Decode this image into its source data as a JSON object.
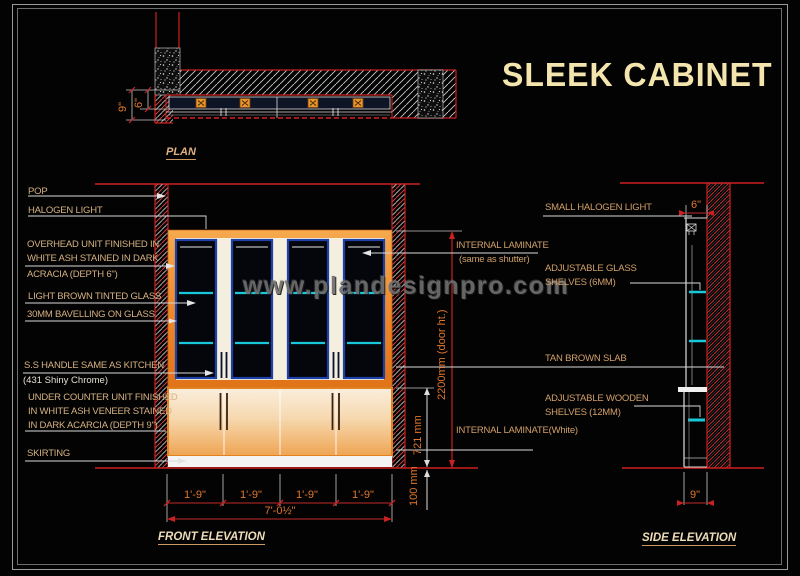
{
  "title": "SLEEK CABINET",
  "watermark": "www.plandesignpro.com",
  "colors": {
    "background": "#030303",
    "wall_red": "#cc2020",
    "cabinet_orange": "#e8872a",
    "shelf_cyan": "#18c8d8",
    "door_navy": "#1d41a8",
    "callout_tan": "#d6b283",
    "dim_orange": "#e0762c",
    "title_cream": "#f3e5ad"
  },
  "plan": {
    "label": "PLAN",
    "dim_depth_total": "9\"",
    "dim_depth_unit": "6\""
  },
  "front": {
    "label": "FRONT ELEVATION",
    "dim_segment": "1'-9\"",
    "dim_total": "7'-0½\"",
    "dim_door_height": "2200mm (door ht.)",
    "dim_counter_height": "721 mm",
    "dim_plinth": "100 mm"
  },
  "side": {
    "label": "SIDE ELEVATION",
    "dim_top_depth": "6\"",
    "dim_bottom_depth": "9\""
  },
  "callouts": {
    "left": {
      "pop": "POP",
      "halogen": "HALOGEN LIGHT",
      "overhead": [
        "OVERHEAD UNIT FINISHED IN",
        "WHITE ASH STAINED IN DARK",
        "ACRACIA (DEPTH 6\")"
      ],
      "tinted_glass": "LIGHT BROWN TINTED GLASS",
      "bevel": "30MM BAVELLING ON GLASS",
      "handle": "S.S HANDLE SAME AS KITCHEN",
      "handle_finish": "(431 Shiny Chrome)",
      "under_counter": [
        "UNDER COUNTER UNIT FINISHED",
        "IN WHITE ASH VENEER STAINED",
        "IN DARK ACARCIA (DEPTH 9\")"
      ],
      "skirting": "SKIRTING"
    },
    "right": {
      "small_halogen": "SMALL HALOGEN LIGHT",
      "internal_laminate": "INTERNAL LAMINATE",
      "internal_laminate_note": "(same as shutter)",
      "glass_shelves": [
        "ADJUSTABLE GLASS",
        "SHELVES (6MM)"
      ],
      "tan_slab": "TAN BROWN SLAB",
      "wooden_shelves": [
        "ADJUSTABLE WOODEN",
        "SHELVES (12MM)"
      ],
      "internal_laminate_white": "INTERNAL LAMINATE(White)"
    }
  }
}
